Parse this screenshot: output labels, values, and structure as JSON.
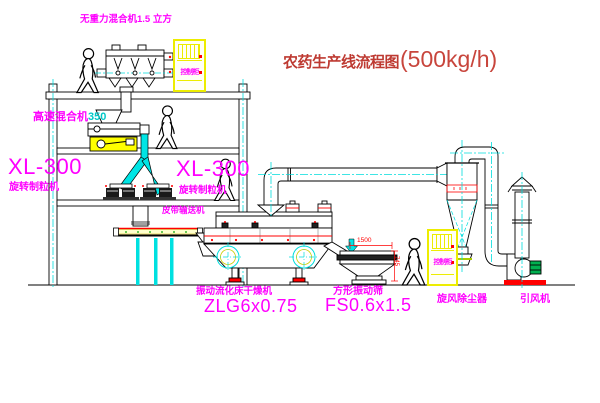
{
  "title": {
    "main": "农药生产线流程图",
    "capacity": "(500kg/h)"
  },
  "labels": {
    "gravity_mixer": "无重力混合机1.5 立方",
    "high_speed_mixer_name": "高速混合机",
    "high_speed_mixer_size": "350",
    "granulator_left_model": "XL-300",
    "granulator_left_name": "旋转制粒机",
    "granulator_right_model": "XL-300",
    "granulator_right_name": "旋转制粒机",
    "belt_conveyor": "皮带输送机",
    "dryer_name": "振动流化床干燥机",
    "dryer_model": "ZLG6x0.75",
    "screen_name": "方形振动筛",
    "screen_model": "FS0.6x1.5",
    "cyclone_name": "旋风除尘器",
    "fan_name": "引风机",
    "cabinet_text": "控制柜"
  },
  "dimensions": {
    "screen_length": "1500",
    "screen_height": "745"
  },
  "colors": {
    "label_magenta": "#FF00FF",
    "line_cyan": "#00DDDD",
    "highlight_yellow": "#FFFF00",
    "accent_red": "#FF0000",
    "title_red": "#BE3A32",
    "motor_green": "#00B050"
  }
}
